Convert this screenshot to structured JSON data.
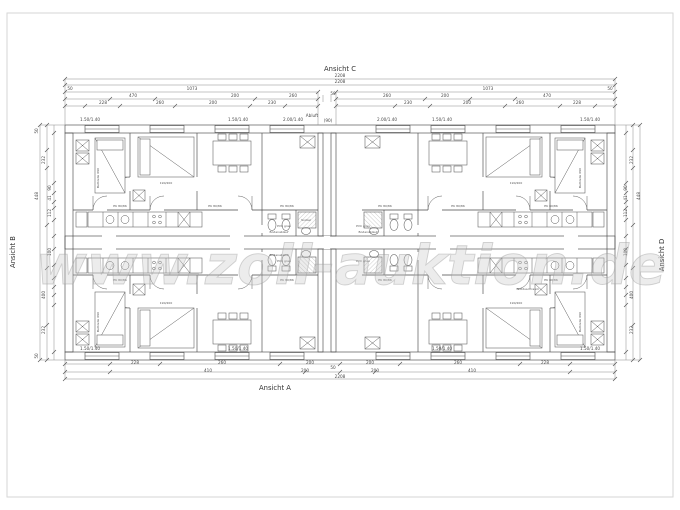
{
  "annotations": {
    "view_top": "Ansicht C",
    "view_bottom": "Ansicht A",
    "view_left": "Ansicht B",
    "view_right": "Ansicht D"
  },
  "watermark": {
    "text": "www.zoll-auktion.de"
  },
  "colors": {
    "line": "#4a4a4a",
    "dim_line": "#8c8c8c",
    "hatch": "#9a9a9a",
    "watermark": "#c4c4c4",
    "frame": "#d6d6d6"
  },
  "dim_texts": [
    {
      "t": "2208",
      "x": 340,
      "y": 77
    },
    {
      "t": "2208",
      "x": 340,
      "y": 83
    },
    {
      "t": "50",
      "x": 70,
      "y": 90
    },
    {
      "t": "1073",
      "x": 192,
      "y": 90
    },
    {
      "t": "1073",
      "x": 488,
      "y": 90
    },
    {
      "t": "50",
      "x": 610,
      "y": 90
    },
    {
      "t": "50",
      "x": 333,
      "y": 95
    },
    {
      "t": "470",
      "x": 133,
      "y": 97
    },
    {
      "t": "200",
      "x": 235,
      "y": 97
    },
    {
      "t": "260",
      "x": 293,
      "y": 97
    },
    {
      "t": "260",
      "x": 387,
      "y": 97
    },
    {
      "t": "200",
      "x": 445,
      "y": 97
    },
    {
      "t": "470",
      "x": 547,
      "y": 97
    },
    {
      "t": "228",
      "x": 103,
      "y": 104
    },
    {
      "t": "260",
      "x": 160,
      "y": 104
    },
    {
      "t": "200",
      "x": 213,
      "y": 104
    },
    {
      "t": "230",
      "x": 272,
      "y": 104
    },
    {
      "t": "230",
      "x": 408,
      "y": 104
    },
    {
      "t": "200",
      "x": 467,
      "y": 104
    },
    {
      "t": "260",
      "x": 520,
      "y": 104
    },
    {
      "t": "228",
      "x": 577,
      "y": 104
    },
    {
      "t": "1.50/1.40",
      "x": 90,
      "y": 121,
      "s": 3.1
    },
    {
      "t": "1.50/1.40",
      "x": 238,
      "y": 121,
      "s": 3.1
    },
    {
      "t": "2.00/1.40",
      "x": 293,
      "y": 121,
      "s": 3.1
    },
    {
      "t": "Abluft",
      "x": 312,
      "y": 117,
      "s": 3.1
    },
    {
      "t": "(90)",
      "x": 328,
      "y": 122,
      "s": 3.1
    },
    {
      "t": "2.00/1.40",
      "x": 387,
      "y": 121,
      "s": 3.1
    },
    {
      "t": "1.50/1.40",
      "x": 442,
      "y": 121,
      "s": 3.1
    },
    {
      "t": "1.50/1.40",
      "x": 590,
      "y": 121,
      "s": 3.1
    },
    {
      "t": "228",
      "x": 135,
      "y": 364
    },
    {
      "t": "260",
      "x": 222,
      "y": 364
    },
    {
      "t": "200",
      "x": 310,
      "y": 364
    },
    {
      "t": "200",
      "x": 370,
      "y": 364
    },
    {
      "t": "260",
      "x": 458,
      "y": 364
    },
    {
      "t": "228",
      "x": 545,
      "y": 364
    },
    {
      "t": "410",
      "x": 208,
      "y": 372
    },
    {
      "t": "200",
      "x": 305,
      "y": 372
    },
    {
      "t": "50",
      "x": 333,
      "y": 369
    },
    {
      "t": "200",
      "x": 375,
      "y": 372
    },
    {
      "t": "410",
      "x": 472,
      "y": 372
    },
    {
      "t": "2208",
      "x": 340,
      "y": 378
    },
    {
      "t": "1.50/1.40",
      "x": 90,
      "y": 350,
      "s": 3.1
    },
    {
      "t": "1.50/1.40",
      "x": 238,
      "y": 350,
      "s": 3.1
    },
    {
      "t": "1.50/1.40",
      "x": 442,
      "y": 350,
      "s": 3.1
    },
    {
      "t": "1.50/1.40",
      "x": 590,
      "y": 350,
      "s": 3.1
    },
    {
      "t": "50",
      "x": 38,
      "y": 131,
      "r": -90
    },
    {
      "t": "232",
      "x": 45,
      "y": 160,
      "r": -90
    },
    {
      "t": "448",
      "x": 38,
      "y": 196,
      "r": -90
    },
    {
      "t": "90",
      "x": 51,
      "y": 188,
      "r": -90
    },
    {
      "t": "41",
      "x": 51,
      "y": 198,
      "r": -90
    },
    {
      "t": "112",
      "x": 51,
      "y": 213,
      "r": -90
    },
    {
      "t": "100",
      "x": 51,
      "y": 252,
      "r": -90
    },
    {
      "t": "400",
      "x": 45,
      "y": 295,
      "r": -90
    },
    {
      "t": "232",
      "x": 45,
      "y": 330,
      "r": -90
    },
    {
      "t": "50",
      "x": 38,
      "y": 356,
      "r": -90
    },
    {
      "t": "232",
      "x": 633,
      "y": 160,
      "r": -90
    },
    {
      "t": "448",
      "x": 640,
      "y": 196,
      "r": -90
    },
    {
      "t": "90",
      "x": 627,
      "y": 188,
      "r": -90
    },
    {
      "t": "41",
      "x": 627,
      "y": 198,
      "r": -90
    },
    {
      "t": "112",
      "x": 627,
      "y": 213,
      "r": -90
    },
    {
      "t": "100",
      "x": 627,
      "y": 252,
      "r": -90
    },
    {
      "t": "400",
      "x": 633,
      "y": 295,
      "r": -90
    },
    {
      "t": "232",
      "x": 633,
      "y": 330,
      "r": -90
    }
  ],
  "plan_texts": [
    {
      "t": "Bettzelle 090",
      "x": 99,
      "y": 178,
      "r": -90
    },
    {
      "t": "190/200",
      "x": 166,
      "y": 184
    },
    {
      "t": "EK 80/86",
      "x": 120,
      "y": 207
    },
    {
      "t": "EK 80/86",
      "x": 215,
      "y": 207
    },
    {
      "t": "EK 80/86",
      "x": 287,
      "y": 207
    },
    {
      "t": "PVC grau",
      "x": 284,
      "y": 227
    },
    {
      "t": "Bodenablauf",
      "x": 279,
      "y": 233
    },
    {
      "t": "Sockel",
      "x": 306,
      "y": 221
    },
    {
      "t": "EK 80/86",
      "x": 385,
      "y": 207
    },
    {
      "t": "EK 80/86",
      "x": 458,
      "y": 207
    },
    {
      "t": "EK 80/86",
      "x": 551,
      "y": 207
    },
    {
      "t": "PVC grau",
      "x": 363,
      "y": 227
    },
    {
      "t": "Bodenablauf",
      "x": 368,
      "y": 233
    },
    {
      "t": "Bettzelle 090",
      "x": 581,
      "y": 178,
      "r": -90
    },
    {
      "t": "190/200",
      "x": 516,
      "y": 184
    },
    {
      "t": "Bettzelle 090",
      "x": 99,
      "y": 322,
      "r": -90
    },
    {
      "t": "190/200",
      "x": 166,
      "y": 304
    },
    {
      "t": "EK 80/86",
      "x": 120,
      "y": 281
    },
    {
      "t": "EK 80/86",
      "x": 287,
      "y": 281
    },
    {
      "t": "PVC grau",
      "x": 284,
      "y": 262
    },
    {
      "t": "Bodenablauf",
      "x": 279,
      "y": 256
    },
    {
      "t": "EK 80/86",
      "x": 385,
      "y": 281
    },
    {
      "t": "EK 80/86",
      "x": 551,
      "y": 281
    },
    {
      "t": "PVC grau",
      "x": 363,
      "y": 262
    },
    {
      "t": "Notduschraum",
      "x": 528,
      "y": 290
    },
    {
      "t": "Bettzelle 090",
      "x": 581,
      "y": 322,
      "r": -90
    },
    {
      "t": "190/200",
      "x": 516,
      "y": 304
    }
  ]
}
